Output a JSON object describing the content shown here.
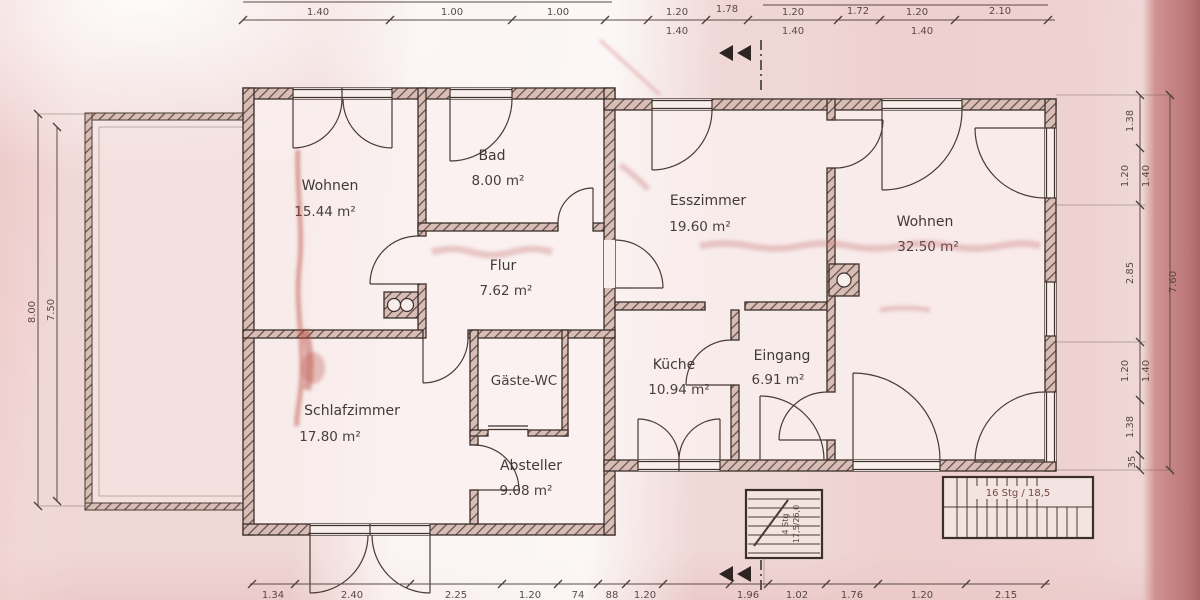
{
  "document": {
    "type": "floor-plan-photo",
    "language": "de",
    "units": "m"
  },
  "colors": {
    "paper": "#efd7d6",
    "paper_edge_band": "#bc7878",
    "ink": "#3a2f2a",
    "dim_ink": "#52423c",
    "stain_red": "#b5473c"
  },
  "rooms": [
    {
      "name": "Wohnen",
      "area": "15.44 m²"
    },
    {
      "name": "Bad",
      "area": "8.00 m²"
    },
    {
      "name": "Flur",
      "area": "7.62 m²"
    },
    {
      "name": "Esszimmer",
      "area": "19.60 m²"
    },
    {
      "name": "Wohnen",
      "area": "32.50 m²"
    },
    {
      "name": "Küche",
      "area": "10.94 m²"
    },
    {
      "name": "Eingang",
      "area": "6.91 m²"
    },
    {
      "name": "Schlafzimmer",
      "area": "17.80 m²"
    },
    {
      "name": "Gäste-WC",
      "area": ""
    },
    {
      "name": "Absteller",
      "area": "9.08 m²"
    }
  ],
  "stairs": {
    "main_label": "16 Stg / 18,5",
    "entry_line1": "4 Stg",
    "entry_line2": "17,5/26,0"
  },
  "dims": {
    "top_upper": [
      "1.40",
      "1.00",
      "1.00",
      "1.20",
      "1.78",
      "1.20",
      "1.72",
      "1.20",
      "2.10"
    ],
    "top_lower": [
      "1.40",
      "1.40",
      "1.40"
    ],
    "bottom": [
      "1.34",
      "2.40",
      "2.25",
      "1.20",
      "74",
      "88",
      "1.20",
      "1.96",
      "1.02",
      "1.76",
      "1.20",
      "2.15"
    ],
    "left": [
      "8.00",
      "7.50"
    ],
    "right": [
      "1.38",
      "1.20",
      "1.40",
      "2.85",
      "1.20",
      "1.40",
      "1.38",
      "35"
    ],
    "right_total": "7.60"
  }
}
